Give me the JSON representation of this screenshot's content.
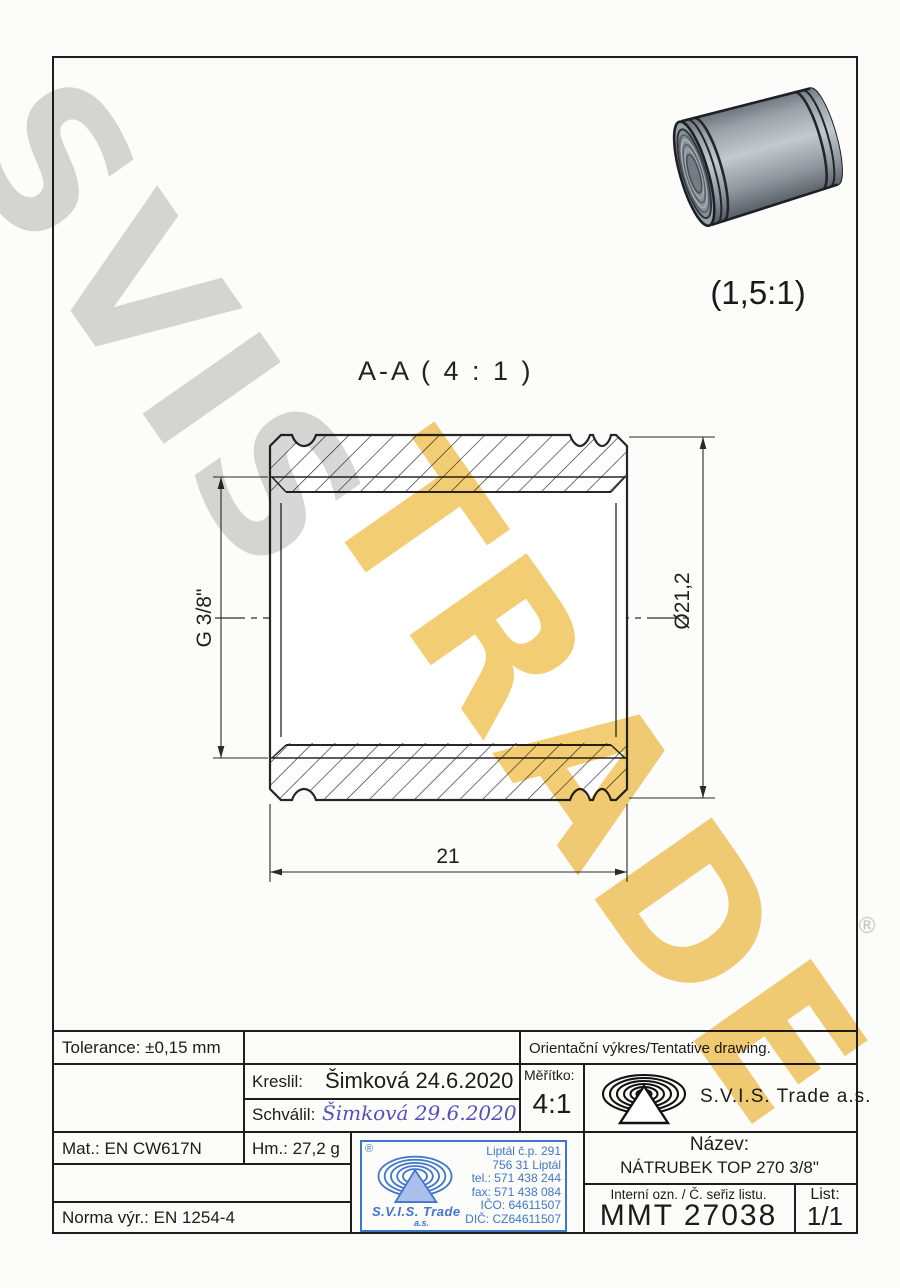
{
  "watermark": {
    "word1": "SVIS",
    "word2": "TRADE",
    "registered": "®",
    "gray_color": "#d7d7d7",
    "gold_color": "#f3cd74"
  },
  "views": {
    "detail_scale_label": "(1,5:1)",
    "section_label": "A-A ( 4 : 1 )",
    "dimensions": {
      "thread": "G 3/8\"",
      "outer_diameter": "Ø21,2",
      "length": "21"
    }
  },
  "title_block": {
    "tolerance": "Tolerance: ±0,15 mm",
    "tentative": "Orientační výkres/Tentative drawing.",
    "kreslil_label": "Kreslil:",
    "kreslil_value": "Šimková 24.6.2020",
    "schvalil_label": "Schválil:",
    "schvalil_value": "Šimková 29.6.2020",
    "meritko_label": "Měřítko:",
    "meritko_value": "4:1",
    "company": "S.V.I.S. Trade a.s.",
    "material": "Mat.: EN CW617N",
    "weight": "Hm.: 27,2 g",
    "norm": "Norma výr.: EN 1254-4",
    "nazev_label": "Název:",
    "nazev_value": "NÁTRUBEK TOP 270 3/8\"",
    "interni_label": "Interní ozn. / Č. seřiz listu.",
    "interni_value": "MMT 27038",
    "list_label": "List:",
    "list_value": "1/1",
    "line_color": "#1e1e1e"
  },
  "stamp": {
    "registered": "®",
    "company": "S.V.I.S. Trade",
    "suffix": "a.s.",
    "color": "#3f76cc",
    "lines": [
      "Liptál č.p. 291",
      "756 31 Liptál",
      "tel.: 571 438 244",
      "fax: 571 438 084",
      "IČO: 64611507",
      "DIČ: CZ64611507"
    ]
  }
}
